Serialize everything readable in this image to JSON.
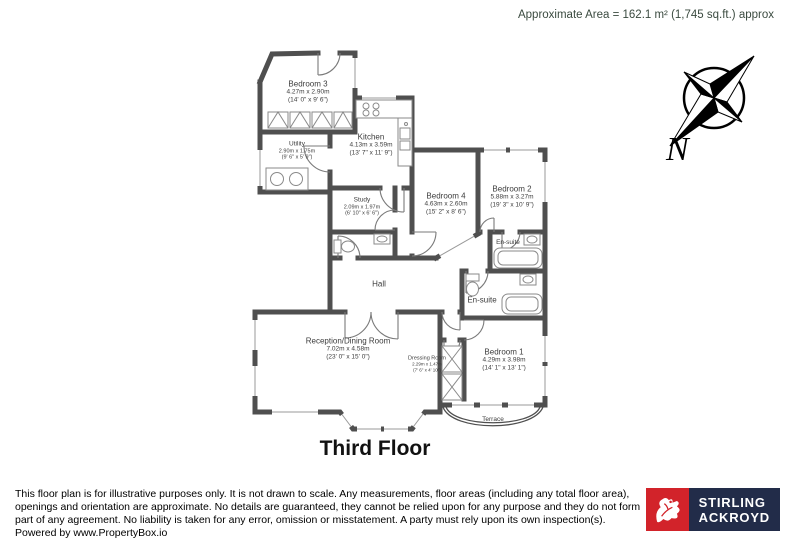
{
  "header": {
    "area_text": "Approximate Area = 162.1 m² (1,745 sq.ft.) approx"
  },
  "compass": {
    "north_label": "N"
  },
  "plan": {
    "title": "Third Floor",
    "rooms": {
      "bedroom3": {
        "name": "Bedroom 3",
        "metric": "4.27m x 2.90m",
        "imperial": "(14' 0\" x 9' 6\")"
      },
      "kitchen": {
        "name": "Kitchen",
        "metric": "4.13m x 3.59m",
        "imperial": "(13' 7\" x 11' 9\")"
      },
      "utility": {
        "name": "Utility",
        "metric": "2.90m x 1.75m",
        "imperial": "(9' 6\" x 5' 9\")"
      },
      "study": {
        "name": "Study",
        "metric": "2.09m x 1.97m",
        "imperial": "(6' 10\" x 6' 6\")"
      },
      "bedroom4": {
        "name": "Bedroom 4",
        "metric": "4.63m x 2.60m",
        "imperial": "(15' 2\" x 8' 6\")"
      },
      "bedroom2": {
        "name": "Bedroom 2",
        "metric": "5.88m x 3.27m",
        "imperial": "(19' 3\" x 10' 9\")"
      },
      "ensuite_small": {
        "name": "En-suite"
      },
      "ensuite_large": {
        "name": "En-suite"
      },
      "hall": {
        "name": "Hall"
      },
      "reception": {
        "name": "Reception/Dining Room",
        "metric": "7.02m x 4.58m",
        "imperial": "(23' 0\" x 15' 0\")"
      },
      "dressing": {
        "name": "Dressing Room",
        "metric": "2.29m x 1.47m",
        "imperial": "(7' 6\" x 4' 10\")"
      },
      "bedroom1": {
        "name": "Bedroom 1",
        "metric": "4.29m x 3.98m",
        "imperial": "(14' 1\" x 13' 1\")"
      },
      "terrace": {
        "name": "Terrace"
      }
    }
  },
  "footer": {
    "disclaimer": "This floor plan is for illustrative purposes only. It is not drawn to scale. Any measurements, floor areas (including any total floor area), openings and orientation are approximate. No details are guaranteed, they cannot be relied upon for any purpose and they do not form part of any agreement. No liability is taken for any error, omission or misstatement. A party must rely upon its own inspection(s).",
    "powered_by": "Powered by www.PropertyBox.io",
    "logo": {
      "brand_line1": "STIRLING",
      "brand_line2": "ACKROYD"
    }
  },
  "colors": {
    "wall": "#4f4f4f",
    "area_text": "#3a4a3f",
    "logo_red": "#d2232a",
    "logo_navy": "#222c49"
  }
}
